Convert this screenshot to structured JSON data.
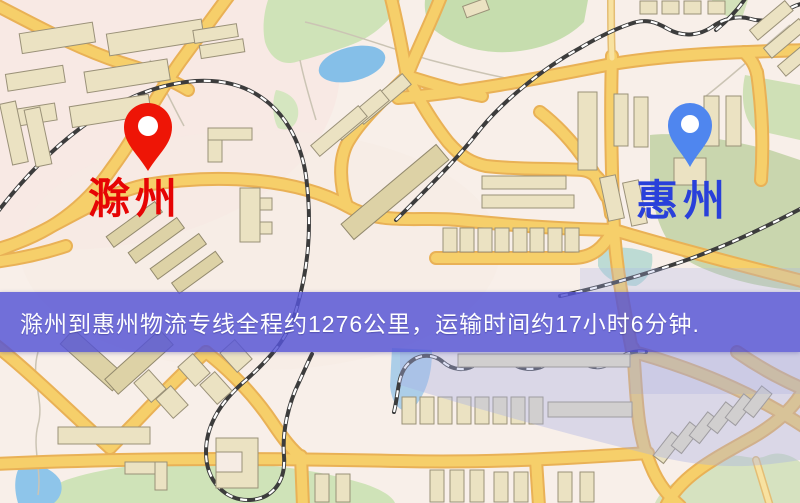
{
  "map": {
    "origin": {
      "name": "滁州",
      "pin_color": "#ee1506",
      "label_color": "#e60404"
    },
    "destination": {
      "name": "惠州",
      "pin_color": "#4f86ef",
      "label_color": "#2940da"
    },
    "banner": {
      "text": "滁州到惠州物流专线全程约1276公里，运输时间约17小时6分钟.",
      "background_color": "#5654d5",
      "text_color": "#ffffff"
    },
    "palette": {
      "background": "#f8efe9",
      "road": "#f6cf6a",
      "road_casing": "#e9b156",
      "park": "#cfe3b8",
      "water": "#85bfe8",
      "railway": "#3c3c3c",
      "building": "#ebe2c2"
    }
  }
}
